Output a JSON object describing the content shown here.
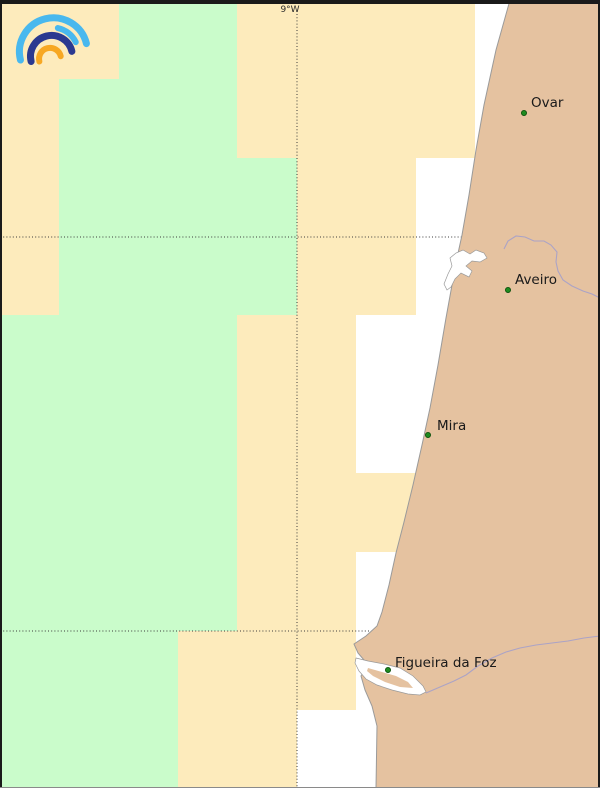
{
  "graticule": {
    "meridian": {
      "label": "9°W",
      "x": 297,
      "label_x": 290,
      "label_y": 12,
      "line_top": 14
    },
    "parallels_y": [
      237,
      631
    ],
    "line_color": "#3a3a3a"
  },
  "cells": {
    "col_bounds": [
      0,
      59,
      119,
      178,
      237,
      297,
      356,
      416,
      475
    ],
    "row_bounds": [
      0,
      79,
      158,
      237,
      315,
      394,
      473,
      552,
      631,
      710,
      788
    ],
    "matrix": [
      "OOGGOOOO",
      "OGGGOOOO",
      "OGGGGOOW",
      "OGGGGOOW",
      "GGGGOOWW",
      "GGGGOOWW",
      "GGGGOOOW",
      "GGGGOOWW",
      "GGGOOOWW",
      "GGGOOWWW"
    ],
    "colors": {
      "O": "#FDEBBC",
      "G": "#CAFCCB",
      "W": "none"
    }
  },
  "land": {
    "fill": "#E5C2A0",
    "coast_stroke": "#9a9a9a",
    "coast_points": [
      [
        510,
        0
      ],
      [
        496,
        50
      ],
      [
        484,
        105
      ],
      [
        476,
        150
      ],
      [
        469,
        195
      ],
      [
        462,
        235
      ],
      [
        457,
        258
      ],
      [
        452,
        285
      ],
      [
        446,
        318
      ],
      [
        438,
        365
      ],
      [
        430,
        408
      ],
      [
        422,
        445
      ],
      [
        413,
        485
      ],
      [
        404,
        522
      ],
      [
        396,
        553
      ],
      [
        389,
        585
      ],
      [
        382,
        612
      ],
      [
        377,
        626
      ],
      [
        366,
        636
      ],
      [
        354,
        644
      ],
      [
        358,
        653
      ],
      [
        364,
        660
      ],
      [
        366,
        668
      ],
      [
        361,
        676
      ],
      [
        365,
        690
      ],
      [
        372,
        706
      ],
      [
        377,
        726
      ],
      [
        376,
        788
      ]
    ]
  },
  "water": {
    "fill": "#ffffff",
    "stroke": "#9a9a9a",
    "lagoon_points": [
      [
        447,
        290
      ],
      [
        444,
        284
      ],
      [
        448,
        274
      ],
      [
        452,
        266
      ],
      [
        450,
        258
      ],
      [
        456,
        253
      ],
      [
        463,
        250
      ],
      [
        470,
        254
      ],
      [
        476,
        250
      ],
      [
        484,
        253
      ],
      [
        487,
        258
      ],
      [
        480,
        262
      ],
      [
        472,
        261
      ],
      [
        466,
        266
      ],
      [
        472,
        271
      ],
      [
        469,
        277
      ],
      [
        461,
        273
      ],
      [
        455,
        279
      ],
      [
        451,
        287
      ]
    ],
    "estuary_points": [
      [
        356,
        658
      ],
      [
        368,
        661
      ],
      [
        384,
        664
      ],
      [
        400,
        668
      ],
      [
        413,
        676
      ],
      [
        423,
        686
      ],
      [
        426,
        692
      ],
      [
        420,
        695
      ],
      [
        408,
        694
      ],
      [
        392,
        690
      ],
      [
        377,
        685
      ],
      [
        366,
        679
      ],
      [
        359,
        671
      ],
      [
        355,
        663
      ]
    ],
    "estuary_island_points": [
      [
        368,
        668
      ],
      [
        382,
        672
      ],
      [
        396,
        676
      ],
      [
        408,
        682
      ],
      [
        413,
        688
      ],
      [
        400,
        687
      ],
      [
        385,
        682
      ],
      [
        373,
        676
      ],
      [
        367,
        671
      ]
    ]
  },
  "rivers": {
    "stroke": "#ABA3C6",
    "paths": [
      [
        [
          504,
          249
        ],
        [
          508,
          241
        ],
        [
          516,
          236
        ],
        [
          525,
          237
        ],
        [
          534,
          241
        ],
        [
          544,
          241
        ],
        [
          551,
          245
        ],
        [
          557,
          252
        ],
        [
          556,
          262
        ],
        [
          558,
          271
        ],
        [
          563,
          280
        ],
        [
          572,
          286
        ],
        [
          583,
          291
        ],
        [
          592,
          294
        ],
        [
          600,
          298
        ]
      ],
      [
        [
          426,
          693
        ],
        [
          440,
          687
        ],
        [
          454,
          681
        ],
        [
          466,
          675
        ],
        [
          478,
          666
        ],
        [
          492,
          658
        ],
        [
          506,
          652
        ],
        [
          520,
          648
        ],
        [
          536,
          645
        ],
        [
          552,
          643
        ],
        [
          568,
          641
        ],
        [
          584,
          638
        ],
        [
          600,
          636
        ]
      ]
    ]
  },
  "cities": [
    {
      "name": "Ovar",
      "x": 524,
      "y": 113,
      "label_dx": 7,
      "label_dy": -6
    },
    {
      "name": "Aveiro",
      "x": 508,
      "y": 290,
      "label_dx": 7,
      "label_dy": -6
    },
    {
      "name": "Mira",
      "x": 428,
      "y": 435,
      "label_dx": 9,
      "label_dy": -5
    },
    {
      "name": "Figueira da Foz",
      "x": 388,
      "y": 670,
      "label_dx": 7,
      "label_dy": -3
    }
  ],
  "city_style": {
    "dot_fill": "#1e8a1e",
    "dot_stroke": "#0b4d0b",
    "dot_radius": 2.6,
    "label_color": "#1a1a1a"
  },
  "frame": {
    "top_color": "#1a1a1a",
    "side_color": "#1a1a1a",
    "bottom_color": "#8a8a8a"
  },
  "logo": {
    "arc_outer_color": "#49B8EE",
    "arc_middle_color": "#2B3990",
    "arc_inner_color": "#F7A823"
  }
}
